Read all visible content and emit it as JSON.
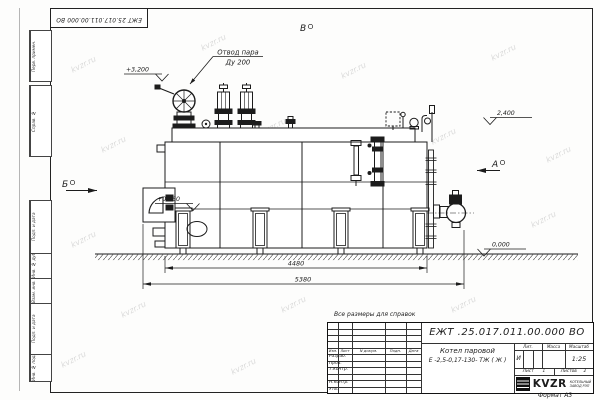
{
  "page": {
    "watermark": "kvzr.ru",
    "format_note": "Формат А3",
    "ref_note": "Все размеры для справок"
  },
  "corner_stamp": "ЕЖТ 25.017.011.00.000  ВО",
  "margin_boxes": [
    "Перв. примен.",
    "Справ. №",
    "Подп. и дата",
    "Инв. № дубл.",
    "Взам. инв. №",
    "Подп. и дата",
    "Инв. № подл."
  ],
  "drawing": {
    "steam_outlet_label_1": "Отвод пара",
    "steam_outlet_label_2": "Ду 200",
    "elevations": {
      "e1": "+3,200",
      "e2": "+0,960",
      "e3": "2,400",
      "e4": "0,000"
    },
    "views": {
      "a": "А",
      "b": "Б",
      "v": "В"
    },
    "dimensions": {
      "inner": "4480",
      "outer": "5380"
    }
  },
  "title_block": {
    "doc_number": "ЕЖТ .25.017.011.00.000  ВО",
    "header": {
      "izm": "Изм.",
      "list": "Лист",
      "doc": "N докум.",
      "podp": "Подп.",
      "data": "Дата"
    },
    "rows": [
      "Разраб.",
      "Пров.",
      "Т.контр.",
      "",
      "Н.контр.",
      "Утв."
    ],
    "product_line1": "Котел паровой",
    "product_line2": "Е -2,5-0,17-130- ТЖ ( Ж )",
    "lit_label": "Лит.",
    "lit_value": "И",
    "mass_label": "Масса",
    "scale_label": "Масштаб",
    "scale_value": "1:25",
    "sheet_label": "Лист",
    "sheet_value": "1",
    "sheets_label": "Листов",
    "sheets_value": "2",
    "logo_text": "KVZR",
    "logo_sub_1": "КОТЕЛЬНЫЙ",
    "logo_sub_2": "ЗАВОД РЭП"
  }
}
